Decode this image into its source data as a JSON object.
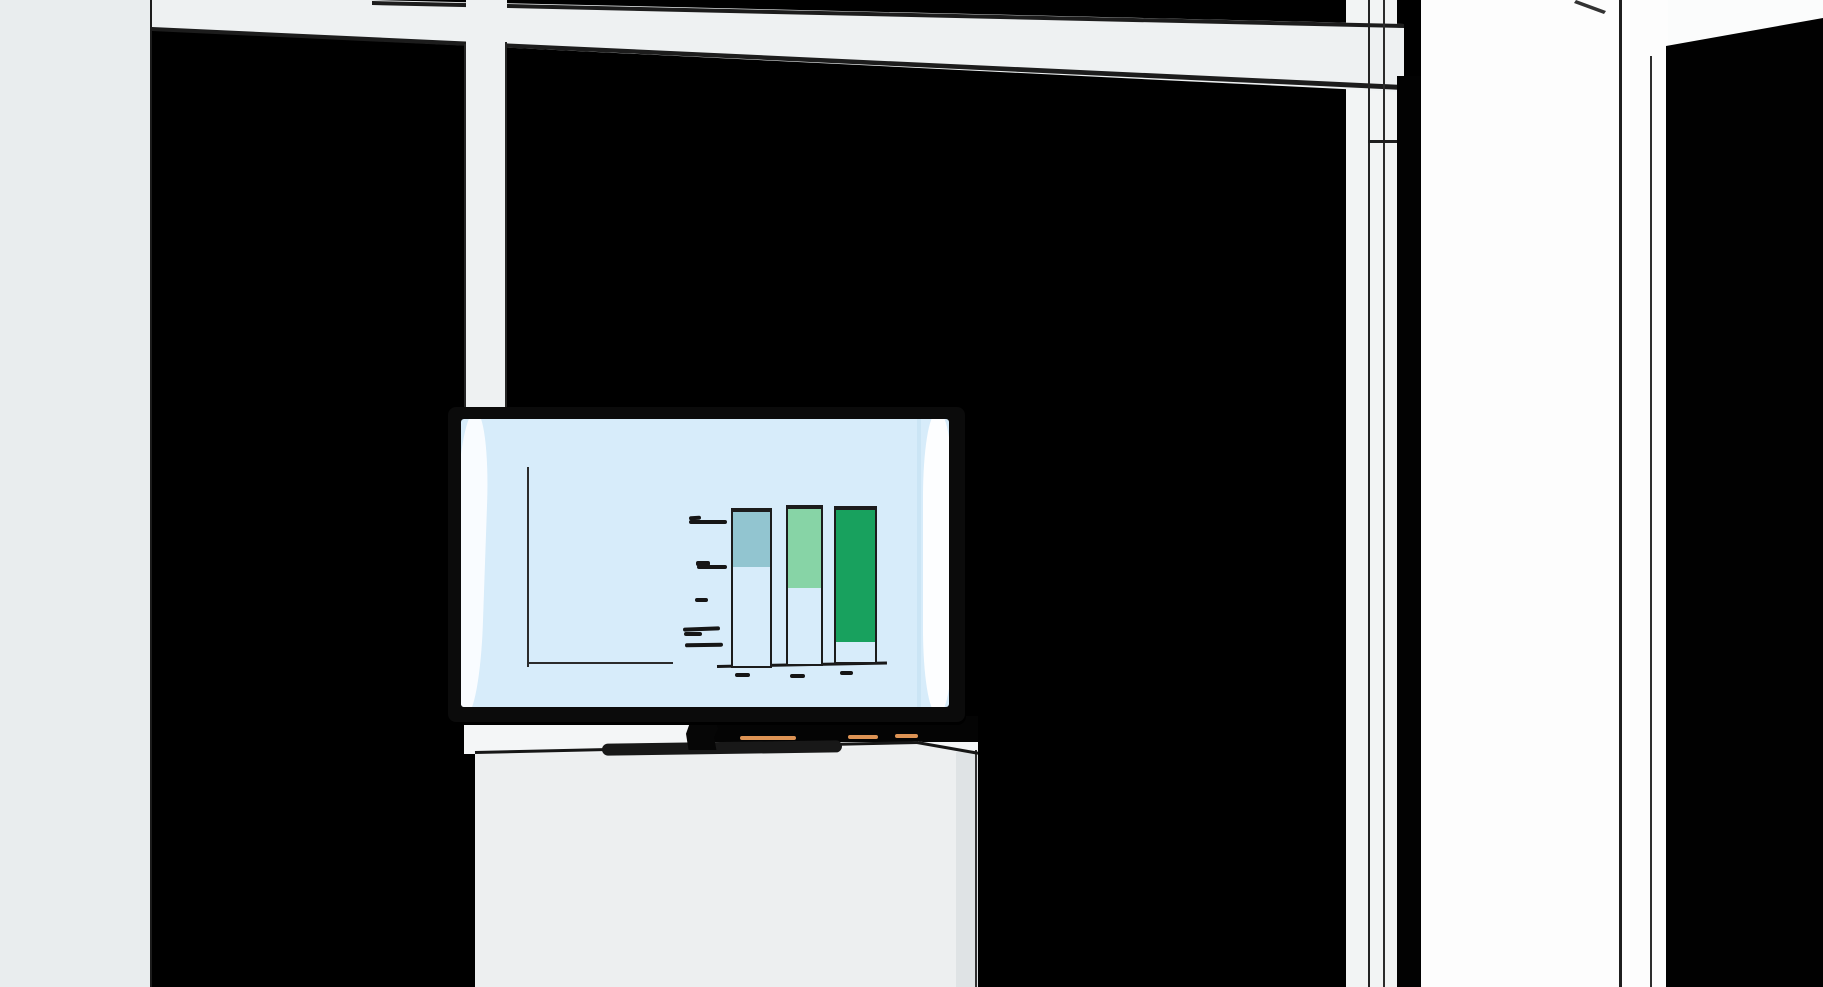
{
  "scene": {
    "setting": "illustrated office interior, dark wall with white window frames",
    "objects": [
      "window-grid",
      "wall-mounted tv on stand",
      "soundbar",
      "white media cabinet"
    ]
  },
  "colors": {
    "background": "#000000",
    "panel_white": "#eef1f2",
    "left_panel": "#e9edee",
    "line_dark": "#1c1c1c",
    "screen_blue": "#d7ecfa",
    "bezel_black": "#0b0b0b",
    "highlight_white": "#ffffff",
    "dark_green": "#18a15e",
    "light_green": "#87d4a6",
    "light_blue": "#92c5d0",
    "cabinet_white": "#edeff0",
    "cabinet_shade": "#dfe3e5",
    "soundbar_black": "#181818",
    "accent_orange": "#dd9354"
  },
  "chart_data": {
    "type": "bar",
    "stacked": true,
    "orientation": "vertical",
    "title": "",
    "xlabel": "",
    "ylabel": "",
    "legend": "none",
    "grid": false,
    "axis_labels_rendered_as": "sketch dashes (no readable text in image)",
    "categories": [
      "bar-1",
      "bar-2",
      "bar-3"
    ],
    "unit": "relative height units (no numeric labels visible)",
    "ylim": [
      0,
      170
    ],
    "bars": [
      {
        "category": "bar-1",
        "total": 156,
        "segments": [
          {
            "color": "dark_green",
            "value": 26
          },
          {
            "color": "light_green",
            "value": 50
          },
          {
            "color": "dark_green",
            "value": 23
          },
          {
            "color": "light_blue",
            "value": 57
          }
        ]
      },
      {
        "category": "bar-2",
        "total": 157,
        "segments": [
          {
            "color": "dark_green",
            "value": 12
          },
          {
            "color": "dark_green",
            "value": 14
          },
          {
            "color": "dark_green",
            "value": 50
          },
          {
            "color": "light_green",
            "value": 81
          }
        ]
      },
      {
        "category": "bar-3",
        "total": 154,
        "segments": [
          {
            "color": "dark_green",
            "value": 9
          },
          {
            "color": "light_green",
            "value": 11
          },
          {
            "color": "dark_green",
            "value": 134
          }
        ]
      }
    ]
  }
}
